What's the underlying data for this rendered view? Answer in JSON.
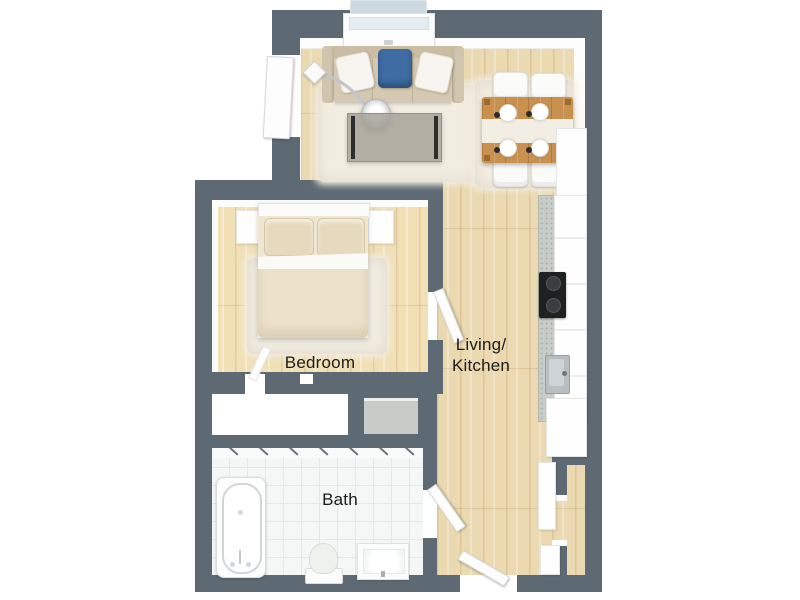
{
  "plan": {
    "type": "apartment-floor-plan-3d-top-view",
    "rooms": [
      {
        "id": "bedroom",
        "label": "Bedroom"
      },
      {
        "id": "bath",
        "label": "Bath"
      },
      {
        "id": "living_kitchen",
        "label_line1": "Living/",
        "label_line2": "Kitchen"
      }
    ],
    "fixtures": [
      "sofa",
      "floor-lamp",
      "coffee-table",
      "living-rug",
      "dining-table",
      "dining-chairs",
      "dining-rug",
      "kitchen-counter",
      "cooktop",
      "kitchen-sink",
      "kitchen-cabinets",
      "bed",
      "nightstands",
      "bedroom-rug",
      "wardrobe-closet",
      "utility-closet",
      "bathtub",
      "toilet",
      "sink-vanity",
      "window",
      "balcony-door",
      "bedroom-door",
      "bathroom-door",
      "entry-door",
      "entry-niche"
    ],
    "colors": {
      "wall": "#5e6a73",
      "wood_floor": "#ead9b1",
      "tile_floor": "#f5f7f7",
      "tile_line": "#e3e8e9",
      "rug": "#f2ede1",
      "sofa_body": "#d6c9b1",
      "accent_pillow": "#3e6ca3",
      "dining_wood": "#c8914f",
      "counter": "#c9cdc9",
      "cooktop": "#1e2021",
      "label_text": "#1b1b1b",
      "background": "#ffffff"
    }
  }
}
